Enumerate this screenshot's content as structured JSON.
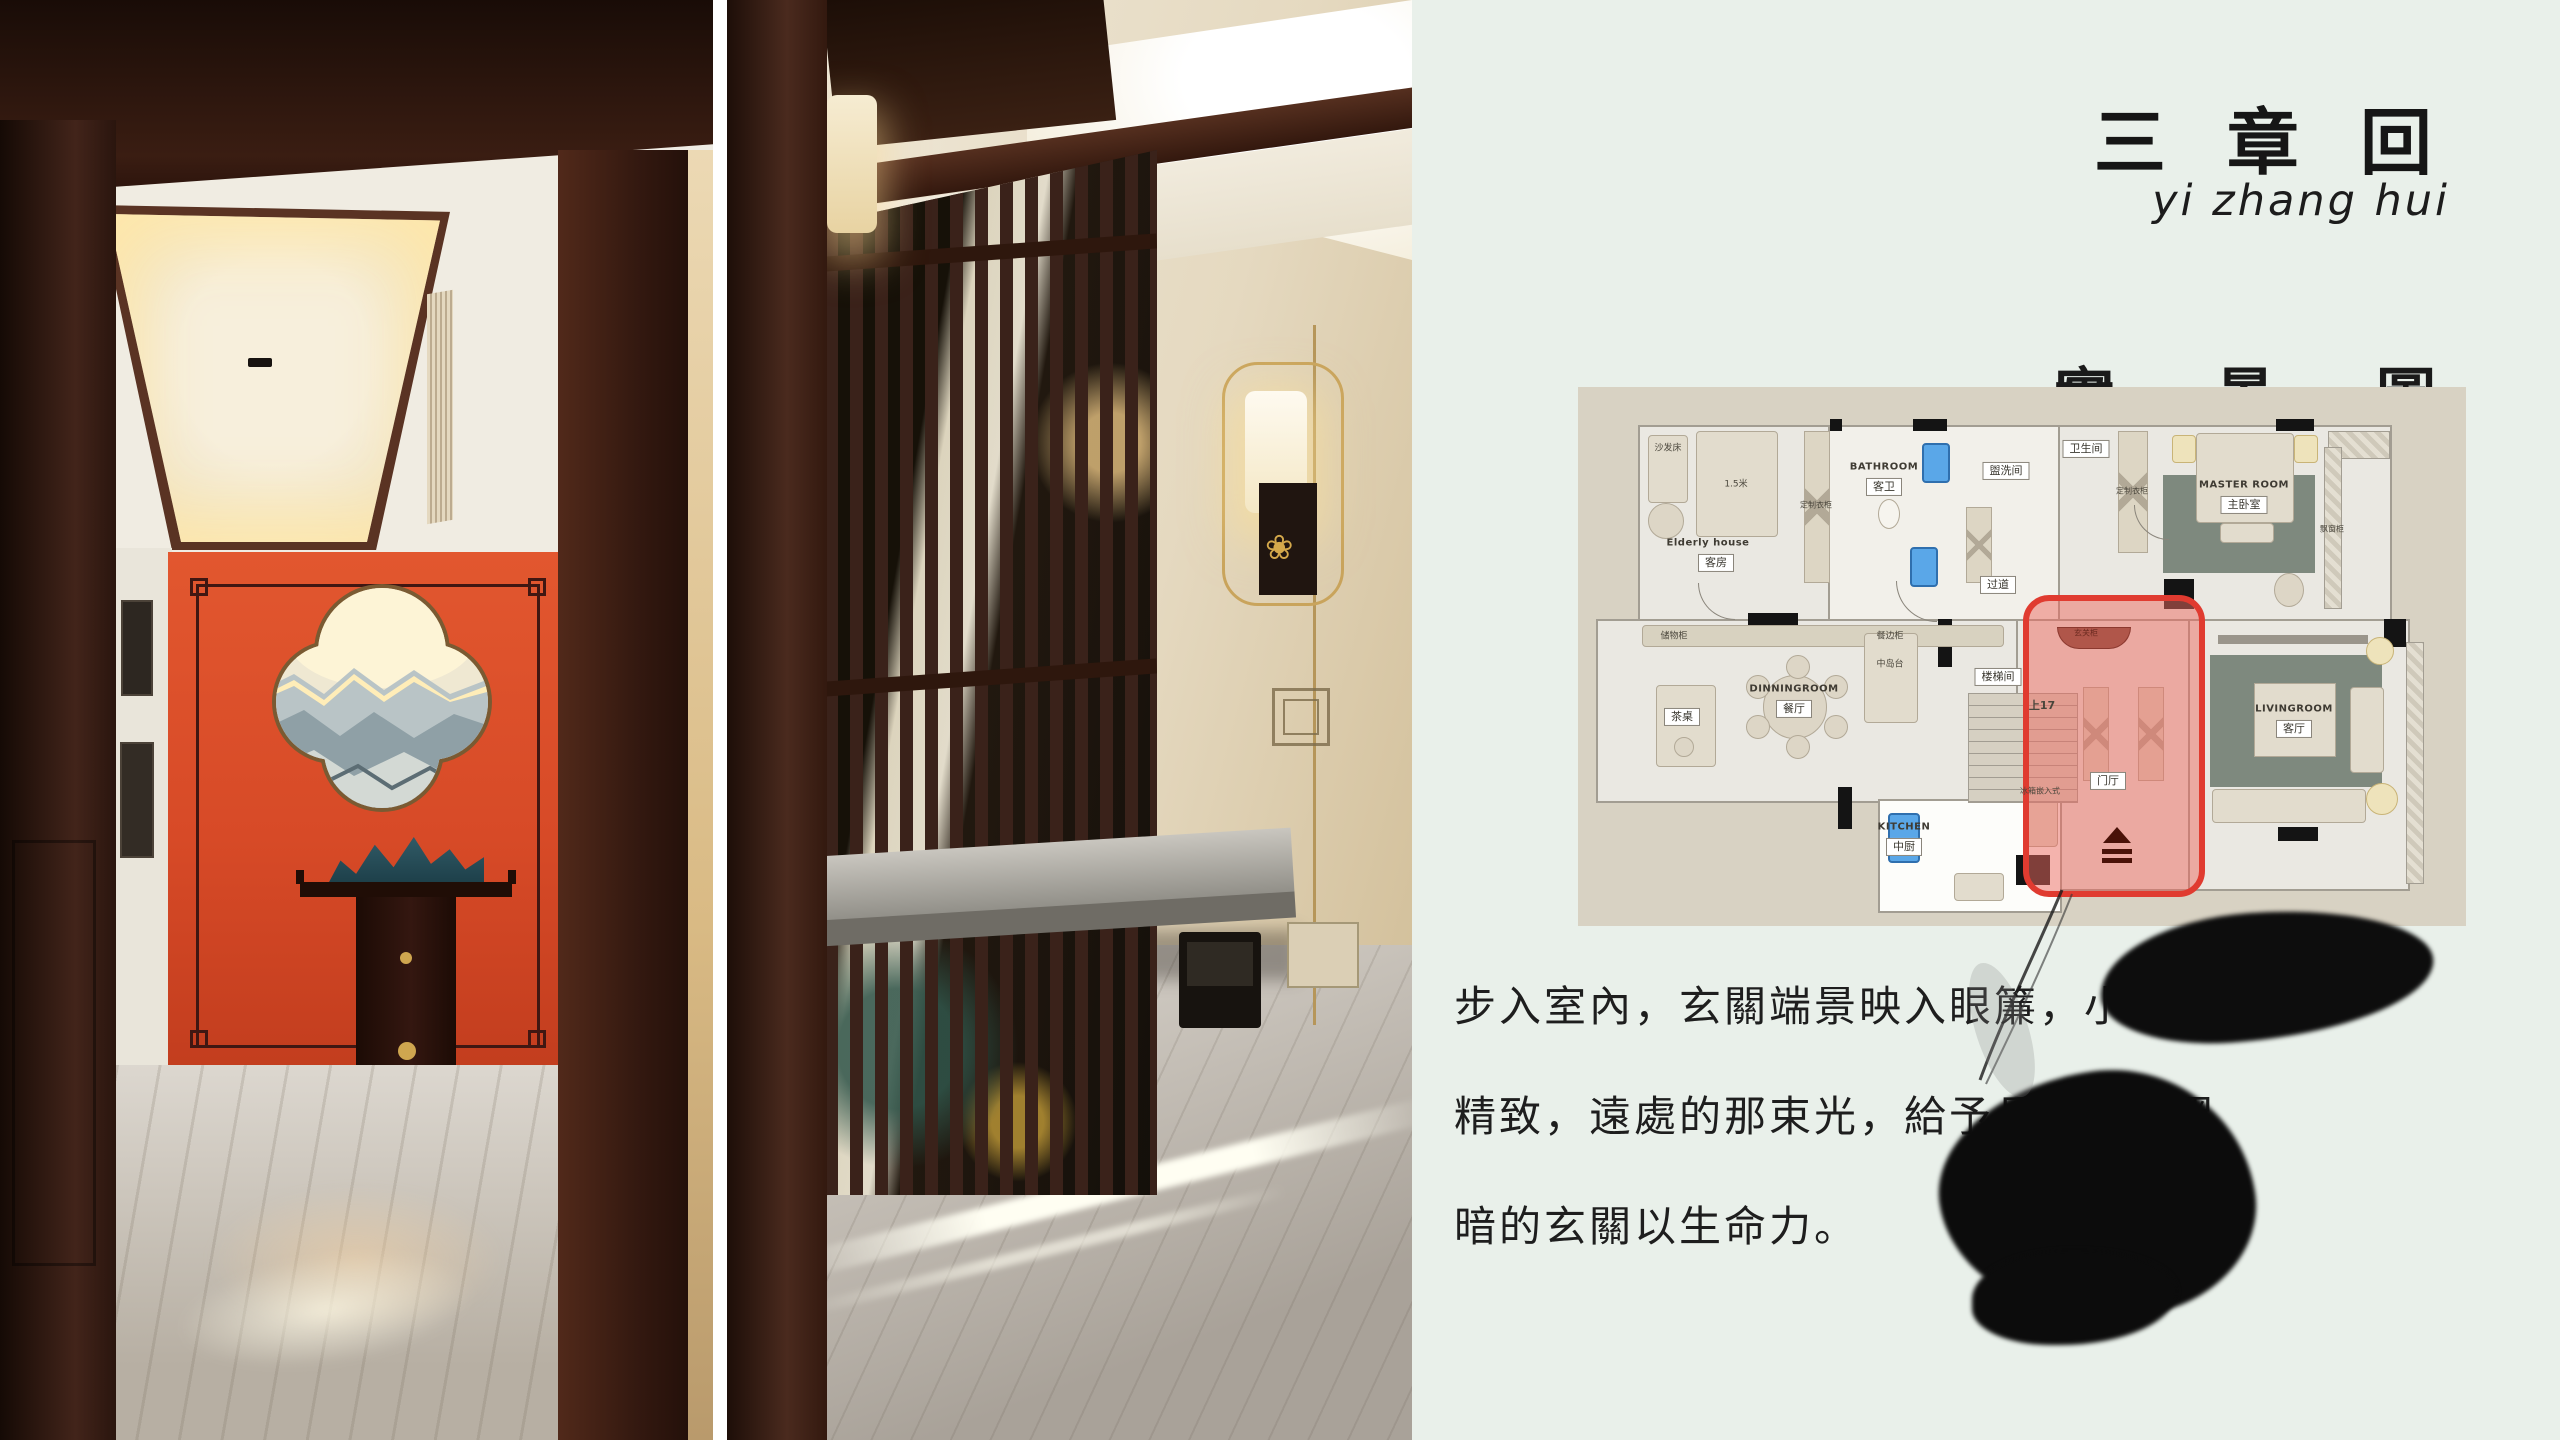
{
  "colors": {
    "panel_bg": "#e9f0ea",
    "accent_wall_red": "#d94a2a",
    "plan_bg": "#d8d2c3",
    "plan_highlight_red": "#e03b30",
    "rug_green": "#7e897e",
    "ink_black": "#0d0d0d"
  },
  "panel": {
    "brand_cn": "三 章 回",
    "brand_pinyin": "yi zhang hui",
    "section_title": "實 景 圖",
    "description_lines": [
      "步入室內，玄關端景映入眼簾，小巧而",
      "精致，遠處的那束光，給予長期處在黑",
      "暗的玄關以生命力。"
    ]
  },
  "floor_plan": {
    "highlight_area": "门厅 entry zone (red outline)",
    "labels": [
      {
        "en": "Elderly house",
        "cn": "客房"
      },
      {
        "en": "BATHROOM",
        "cn": "客卫"
      },
      {
        "cn": "盥洗间"
      },
      {
        "cn": "卫生间"
      },
      {
        "en": "MASTER ROOM",
        "cn": "主卧室"
      },
      {
        "en": "DINNINGROOM",
        "cn": "餐厅"
      },
      {
        "en": "KITCHEN",
        "cn": "中厨"
      },
      {
        "en": "LIVINGROOM",
        "cn": "客厅"
      },
      {
        "cn": "楼梯间"
      },
      {
        "cn": "门厅"
      },
      {
        "cn": "过道"
      },
      {
        "cn": "上17"
      },
      {
        "cn": "茶桌"
      },
      {
        "cn": "中岛台"
      },
      {
        "cn": "1.5米"
      },
      {
        "cn": "沙发床"
      },
      {
        "cn": "定制衣柜"
      },
      {
        "cn": "定制衣柜"
      },
      {
        "cn": "储物柜"
      },
      {
        "cn": "餐边柜"
      },
      {
        "cn": "玄关柜"
      },
      {
        "cn": "冰箱嵌入式"
      },
      {
        "cn": "飘窗柜"
      }
    ]
  }
}
